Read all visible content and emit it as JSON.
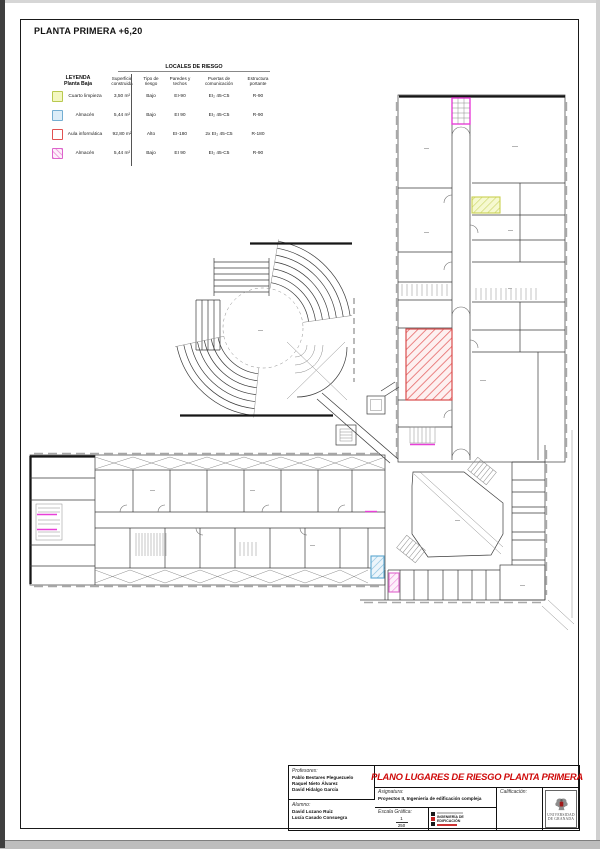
{
  "page": {
    "title": "PLANTA PRIMERA +6,20"
  },
  "legend": {
    "table_title": "LOCALES DE RIESGO",
    "leyenda_title": "LEYENDA",
    "leyenda_subtitle": "Planta Baja",
    "headers": {
      "superficie": "Superficie construida",
      "tipo": "Tipo de riesgo",
      "paredes": "Paredes y techos",
      "puertas": "Puertas de comunicación",
      "estructura": "Estructura portante"
    },
    "rows": [
      {
        "name": "Cuarto limpieza",
        "superficie": "3,50 m²",
        "tipo": "Bajo",
        "paredes": "EI-90",
        "puertas": "EI₂ 45-C5",
        "estructura": "R-90",
        "color": "#f3f7c0",
        "border": "#b9c94f"
      },
      {
        "name": "Almacén",
        "superficie": "5,44 m²",
        "tipo": "Bajo",
        "paredes": "EI 90",
        "puertas": "EI₂ 45-C5",
        "estructura": "R-90",
        "color": "#dcedf8",
        "border": "#74aed2"
      },
      {
        "name": "Aula informática",
        "superficie": "92,80 m²",
        "tipo": "Alto",
        "paredes": "EI-180",
        "puertas": "2x EI₂ 45-C5",
        "estructura": "R-180",
        "color": "#ffffff",
        "border": "#e05252"
      },
      {
        "name": "Almacén",
        "superficie": "5,44 m²",
        "tipo": "Bajo",
        "paredes": "EI 90",
        "puertas": "EI₂ 45-C5",
        "estructura": "R-90",
        "color": "#f9ddf1",
        "border": "#dd64cc"
      }
    ]
  },
  "titleblock": {
    "profesores_label": "Profesores:",
    "profesores": [
      "Pablo Bestares Pleguezuelo",
      "Raquel Nieto Álvarez",
      "David Hidalgo García"
    ],
    "alumno_label": "Alumno:",
    "alumnos": [
      "David Lozano Ruiz",
      "Lucía Casado Consuegra"
    ],
    "plano_title": "PLANO LUGARES DE RIESGO PLANTA PRIMERA",
    "asignatura_label": "Asignatura:",
    "asignatura_value": "Proyectos II, Ingeniería de edificación compleja",
    "calificacion_label": "Calificación:",
    "escala_label": "Escala Gráfica:",
    "escala_numerador": "1",
    "escala_denominador": "250",
    "school_logo_text": "INGENIERÍA DE EDIFICACIÓN",
    "university_line1": "UNIVERSIDAD",
    "university_line2": "DE GRANADA"
  },
  "colors": {
    "title_red": "#cf0a0a",
    "highlight_yellow": "#f3f7c0",
    "highlight_blue": "#74aed2",
    "highlight_red": "#e05252",
    "highlight_magenta": "#dd64cc"
  }
}
